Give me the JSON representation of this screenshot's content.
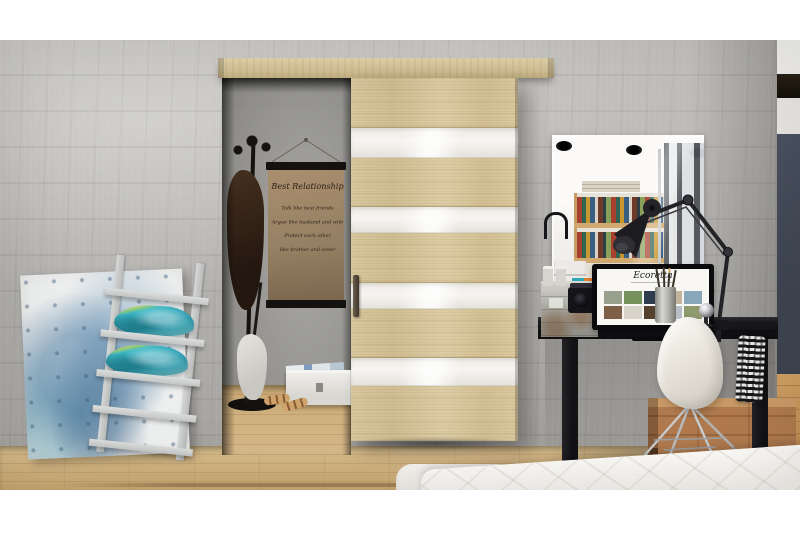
{
  "poster": {
    "title": "Best Relationship",
    "lines": [
      "Talk like best friends",
      "Argue like husband and wife",
      "Protect each other",
      "like brother and sister"
    ]
  },
  "laptop_screen": {
    "brand": "Ecoretta"
  },
  "colors": {
    "margin": "#ffffff",
    "wall": "#b8b6b3",
    "dark-wall": "#3d4450",
    "wood": "#d8c79e",
    "stripe": "#f7f5f1",
    "floor": "#d9be8e",
    "poster-paper": "#a18a6b",
    "ink": "#2e2218",
    "desk": "#1a1a1d",
    "chair": "#f4f1ea",
    "crate": "#b07a4e",
    "bed": "#fbfaf7",
    "pillow": "#3ab7c6",
    "pillow-accent": "#c6d85a",
    "ladder": "#b9bbba"
  }
}
